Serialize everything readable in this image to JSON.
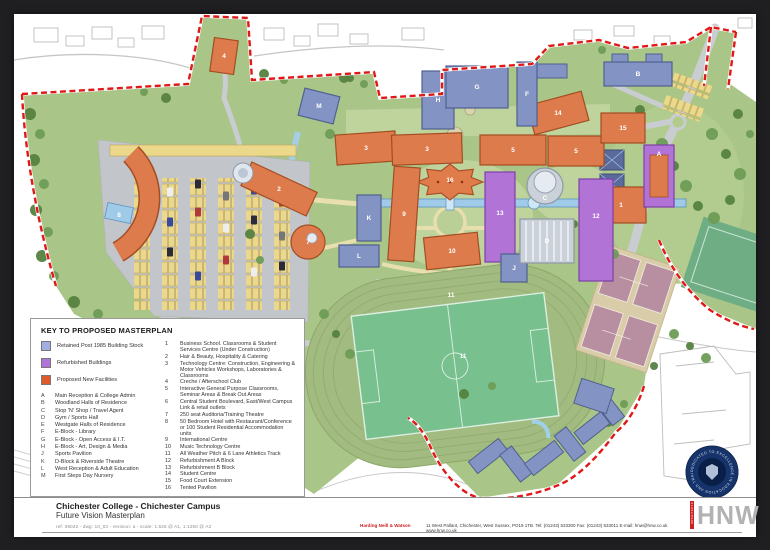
{
  "title_block": {
    "college": "Chichester College - Chichester Campus",
    "subtitle": "Future Vision Masterplan",
    "ref_line": "ref: 06022 - dwg: 10_03 - revision: a - scale: 1:625 @ A1, 1:1250 @ A3",
    "firm_name": "Harding Neill & Watson",
    "firm_address": "11 West Pallant, Chichester, West Sussex, PO19 1TB. Tel: (01243) 533300  Fax: (01243) 533011  E-mail: hnw@hnw.co.uk  www.hnw.co.uk",
    "logo_text": "HNW",
    "logo_vertical_text": "ARCHITECTS"
  },
  "crest": {
    "text": "DEDICATED TO EXCELLENCE IN EDUCATION AND TRAINING"
  },
  "legend": {
    "title": "KEY TO PROPOSED MASTERPLAN",
    "swatches": [
      {
        "label": "Retained Post 1985 Building Stock",
        "color": "#9fb0e0"
      },
      {
        "label": "Refurbished Buildings",
        "color": "#b173d6"
      },
      {
        "label": "Proposed New Facilities",
        "color": "#de5a2c"
      }
    ],
    "lettered_items": [
      {
        "key": "A",
        "label": "Main Reception & College Admin"
      },
      {
        "key": "B",
        "label": "Woodland Halls of Residence"
      },
      {
        "key": "C",
        "label": "Stop 'N' Shop / Travel Agent"
      },
      {
        "key": "D",
        "label": "Gym / Sports Hall"
      },
      {
        "key": "E",
        "label": "Westgate Halls of Residence"
      },
      {
        "key": "F",
        "label": "E-Block - Library"
      },
      {
        "key": "G",
        "label": "E-Block - Open Access & I.T."
      },
      {
        "key": "H",
        "label": "E-Block - Art, Design & Media"
      },
      {
        "key": "J",
        "label": "Sports Pavilion"
      },
      {
        "key": "K",
        "label": "D-Block & Riverside Theatre"
      },
      {
        "key": "L",
        "label": "West Reception & Adult Education"
      },
      {
        "key": "M",
        "label": "First Steps Day Nursery"
      }
    ],
    "numbered_items": [
      {
        "key": "1",
        "label": "Business School. Classrooms & Student Services Centre (Under Construction)"
      },
      {
        "key": "2",
        "label": "Hair & Beauty, Hospitality & Catering"
      },
      {
        "key": "3",
        "label": "Technology Centre: Construction, Engineering & Motor Vehicles Workshops, Laboratories & Classrooms"
      },
      {
        "key": "4",
        "label": "Creche / Afterschool Club"
      },
      {
        "key": "5",
        "label": "Interactive General Purpose Classrooms, Seminar Areas & Break Out Areas"
      },
      {
        "key": "6",
        "label": "Central Student Boulevard, East/West Campus Link & retail outlets"
      },
      {
        "key": "7",
        "label": "250 seat Auditoria/Training Theatre"
      },
      {
        "key": "8",
        "label": "50 Bedroom Hotel with Restaurant/Conference or 100 Student Residential Accommodation units"
      },
      {
        "key": "9",
        "label": "International Centre"
      },
      {
        "key": "10",
        "label": "Music Technology Centre"
      },
      {
        "key": "11",
        "label": "All Weather Pitch & 6 Lane Athletics Track"
      },
      {
        "key": "12",
        "label": "Refurbishment A Block"
      },
      {
        "key": "13",
        "label": "Refurbishment B Block"
      },
      {
        "key": "14",
        "label": "Student Centre"
      },
      {
        "key": "15",
        "label": "Food Court Extension"
      },
      {
        "key": "16",
        "label": "Tented Pavilion"
      }
    ]
  },
  "map": {
    "colors": {
      "proposed": "#de7b4c",
      "proposed_stroke": "#a34d22",
      "retained": "#8394c4",
      "retained_stroke": "#50608f",
      "refurbished": "#b173d6",
      "refurbished_stroke": "#7e3fa8",
      "silver": "#cbd1d9",
      "silver_stroke": "#8f98a6",
      "grass": "#a9c688",
      "boundary": "#e01818",
      "label": "#ffffff"
    },
    "buildings": [
      {
        "label": "4",
        "shape": "rect",
        "x": 210,
        "y": 42,
        "w": 24,
        "h": 34,
        "rot": 8,
        "type": "proposed"
      },
      {
        "label": "2",
        "shape": "rect",
        "x": 265,
        "y": 175,
        "w": 72,
        "h": 26,
        "rot": 25,
        "type": "proposed"
      },
      {
        "label": "7",
        "shape": "circle",
        "x": 294,
        "y": 228,
        "r": 17,
        "type": "proposed"
      },
      {
        "label": "8",
        "shape": "label",
        "x": 105,
        "y": 201
      },
      {
        "label": "3",
        "shape": "rect",
        "x": 352,
        "y": 134,
        "w": 60,
        "h": 30,
        "rot": -4,
        "type": "proposed"
      },
      {
        "label": "3",
        "shape": "rect",
        "x": 413,
        "y": 135,
        "w": 70,
        "h": 30,
        "rot": -2,
        "type": "proposed"
      },
      {
        "label": "5",
        "shape": "rect",
        "x": 499,
        "y": 136,
        "w": 66,
        "h": 30,
        "rot": 0,
        "type": "proposed"
      },
      {
        "label": "5",
        "shape": "rect",
        "x": 562,
        "y": 137,
        "w": 56,
        "h": 30,
        "rot": 0,
        "type": "proposed"
      },
      {
        "label": "14",
        "shape": "rect",
        "x": 544,
        "y": 99,
        "w": 56,
        "h": 30,
        "rot": -15,
        "type": "proposed"
      },
      {
        "label": "15",
        "shape": "rect",
        "x": 609,
        "y": 114,
        "w": 44,
        "h": 30,
        "rot": 0,
        "type": "proposed"
      },
      {
        "label": "1",
        "shape": "rect",
        "x": 607,
        "y": 191,
        "w": 50,
        "h": 36,
        "rot": 0,
        "type": "proposed"
      },
      {
        "label": "9",
        "shape": "rect",
        "x": 390,
        "y": 200,
        "w": 26,
        "h": 94,
        "rot": 4,
        "type": "proposed"
      },
      {
        "label": "10",
        "shape": "rect",
        "x": 438,
        "y": 237,
        "w": 54,
        "h": 32,
        "rot": -6,
        "type": "proposed"
      },
      {
        "label": "16",
        "shape": "label",
        "x": 436,
        "y": 166
      },
      {
        "label": "A",
        "shape": "rect",
        "x": 645,
        "y": 162,
        "w": 30,
        "h": 62,
        "rot": 0,
        "type": "refurbished",
        "inner": true,
        "ldy": -22
      },
      {
        "label": "12",
        "shape": "rect",
        "x": 582,
        "y": 216,
        "w": 34,
        "h": 102,
        "rot": 0,
        "type": "refurbished",
        "ldy": -14
      },
      {
        "label": "13",
        "shape": "rect",
        "x": 486,
        "y": 203,
        "w": 30,
        "h": 90,
        "rot": 0,
        "type": "refurbished",
        "ldy": -4
      },
      {
        "label": "M",
        "shape": "rect",
        "x": 305,
        "y": 92,
        "w": 36,
        "h": 28,
        "rot": 14,
        "type": "retained"
      },
      {
        "label": "H",
        "shape": "rect",
        "x": 424,
        "y": 86,
        "w": 32,
        "h": 58,
        "rot": 0,
        "type": "retained"
      },
      {
        "label": "G",
        "shape": "rect",
        "x": 463,
        "y": 73,
        "w": 62,
        "h": 42,
        "rot": 0,
        "type": "retained"
      },
      {
        "label": "F",
        "shape": "rect",
        "x": 513,
        "y": 80,
        "w": 20,
        "h": 64,
        "rot": 0,
        "type": "retained"
      },
      {
        "label": "B",
        "shape": "rect",
        "x": 624,
        "y": 60,
        "w": 68,
        "h": 24,
        "rot": 0,
        "type": "retained"
      },
      {
        "label": "K",
        "shape": "rect",
        "x": 355,
        "y": 204,
        "w": 24,
        "h": 46,
        "rot": 0,
        "type": "retained"
      },
      {
        "label": "L",
        "shape": "rect",
        "x": 345,
        "y": 242,
        "w": 40,
        "h": 22,
        "rot": 0,
        "type": "retained"
      },
      {
        "label": "J",
        "shape": "rect",
        "x": 500,
        "y": 254,
        "w": 26,
        "h": 28,
        "rot": 0,
        "type": "retained"
      },
      {
        "label": "D",
        "shape": "rect",
        "x": 533,
        "y": 227,
        "w": 54,
        "h": 44,
        "rot": 0,
        "type": "silver"
      },
      {
        "label": "C",
        "shape": "circle",
        "x": 531,
        "y": 172,
        "r": 18,
        "type": "silver",
        "ldy": 12
      },
      {
        "label": "11",
        "shape": "label",
        "x": 437,
        "y": 281
      },
      {
        "label": "11",
        "shape": "label",
        "x": 449,
        "y": 342
      }
    ]
  }
}
